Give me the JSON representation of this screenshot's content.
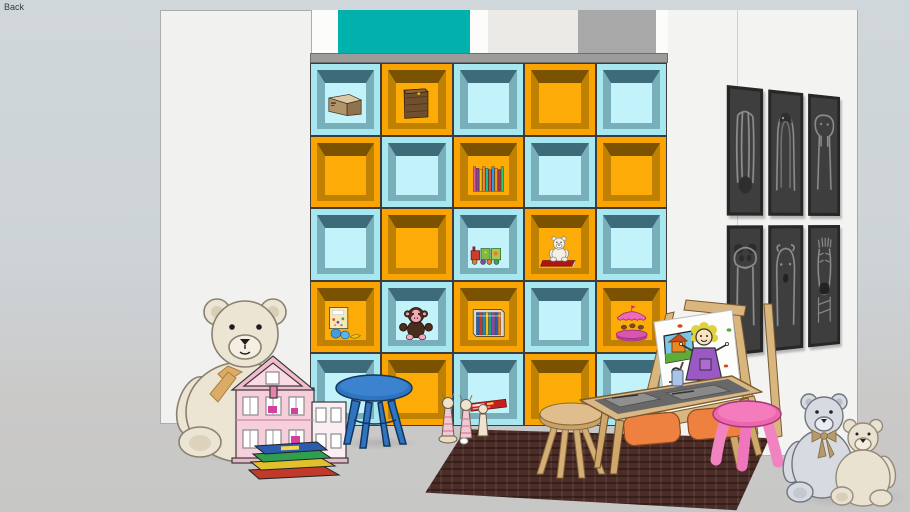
{
  "viewport": {
    "scene_label": "Back"
  },
  "palette": {
    "backdrop_top": "#d0d7db",
    "floor": "#c7c7c6",
    "wall_white": "#f2f2f0",
    "accent_teal_block": "#00b1ac",
    "accent_gray_block": "#a8a8a8",
    "shelf_board_gray": "#9c9c9b",
    "rug_brown": "#4c2c27",
    "wood_light": "#d9b886",
    "bin_orange": "#ef8140",
    "stool_blue": "#2f74c0",
    "stool_pink": "#ee67ae",
    "dollhouse_pink": "#f7cfdc"
  },
  "shelf": {
    "rows": 5,
    "cols": 5,
    "pattern": "checkerboard",
    "colors": {
      "cyan": {
        "frame": "#a6e7f0",
        "back": "#c2f2fa",
        "shade": "#3e6b79",
        "side": "#79aebb"
      },
      "orange": {
        "frame": "#f9a402",
        "back": "#fcab07",
        "shade": "#7a5200",
        "side": "#c08102"
      }
    },
    "items": [
      {
        "row": 0,
        "col": 0,
        "type": "cardboard-box",
        "label": "cardboard box"
      },
      {
        "row": 0,
        "col": 1,
        "type": "wooden-crate",
        "label": "wooden toy crate"
      },
      {
        "row": 1,
        "col": 2,
        "type": "book-row",
        "label": "row of colorful books"
      },
      {
        "row": 2,
        "col": 2,
        "type": "toy-train",
        "label": "toy train with blocks"
      },
      {
        "row": 2,
        "col": 3,
        "type": "teddy-on-book",
        "label": "white teddy on red book"
      },
      {
        "row": 3,
        "col": 0,
        "type": "picture-book-and-balls",
        "label": "picture book with balls"
      },
      {
        "row": 3,
        "col": 1,
        "type": "monkey-plush",
        "label": "brown monkey plush"
      },
      {
        "row": 3,
        "col": 2,
        "type": "book-set",
        "label": "boxed book set"
      },
      {
        "row": 3,
        "col": 4,
        "type": "carousel-toy",
        "label": "pink carousel toy"
      },
      {
        "row": 4,
        "col": 2,
        "type": "game-box",
        "label": "red game box"
      }
    ]
  },
  "art_wall": {
    "panels": [
      {
        "animal": "giraffe"
      },
      {
        "animal": "penguin"
      },
      {
        "animal": "walrus"
      },
      {
        "animal": "panda"
      },
      {
        "animal": "polar-bear"
      },
      {
        "animal": "zebra"
      }
    ]
  },
  "furniture": [
    {
      "name": "large-teddy-bear",
      "color": "#ece5d4"
    },
    {
      "name": "pink-dollhouse",
      "color": "#f7cfdc"
    },
    {
      "name": "book-stack",
      "color": "multicolor"
    },
    {
      "name": "blue-stool",
      "color": "#2f74c0"
    },
    {
      "name": "toy-pins",
      "color": "#efe3cf"
    },
    {
      "name": "play-rug",
      "color": "#4c2c27"
    },
    {
      "name": "wooden-stool",
      "color": "#dfbd8d"
    },
    {
      "name": "craft-table-with-bins",
      "color": "#d9b886"
    },
    {
      "name": "paint-cup",
      "color": "#aac3e8"
    },
    {
      "name": "art-easel-with-drawing",
      "color": "#d8b67e"
    },
    {
      "name": "pink-stool",
      "color": "#ee67ae"
    },
    {
      "name": "gray-teddy-bear",
      "color": "#d7dbe1"
    },
    {
      "name": "cream-teddy-bear",
      "color": "#eae2d0"
    }
  ]
}
